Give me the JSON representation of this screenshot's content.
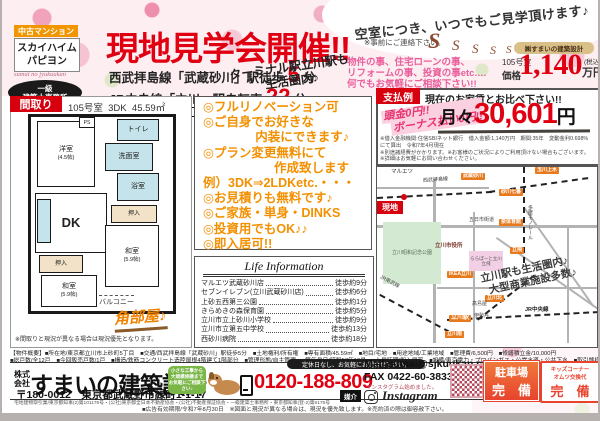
{
  "header": {
    "badge": "中古マンション",
    "building1": "スカイハイム",
    "building2": "パピヨン",
    "script": "sumai no jyukuukan",
    "license1": "一級",
    "license2": "建築士事務所",
    "title": "現地見学会開催!!",
    "access1_pre": "西武拝島線「武蔵砂川」駅徒歩",
    "access1_num": "5",
    "access1_unit": "分",
    "access2_pre": "JR中央線「立川」駅自転車",
    "access2_num": "22",
    "access2_unit": "分",
    "terminal1": "ターミナル駅立川駅も",
    "terminal2": "生活圏内♪",
    "vacancy": "空室につき、いつでもご見学頂けます♪",
    "contact": "※事前にご連絡下さい。",
    "mascot": "S",
    "company_pill": "㈱すまいの建築設計",
    "consult1": "物件の事、住宅ローンの事、",
    "consult2": "リフォームの事、投資の事etc.…",
    "consult3": "何でもお気軽にご相談下さい!!",
    "price_room": "105号室",
    "price_label": "価格",
    "price_value": "1,140",
    "price_tax": "(税込)",
    "price_unit": "万円"
  },
  "madori": {
    "label": "間取り",
    "room_no": "105号室",
    "layout": "3DK",
    "area": "45.59㎡",
    "rooms": {
      "western": "洋室",
      "western_size": "(4.5帖)",
      "ps": "PS",
      "toilet": "トイレ",
      "washroom": "洗面室",
      "bath": "浴室",
      "dk": "DK",
      "closet1": "押入",
      "closet2": "押入",
      "japanese1": "和室",
      "japanese1_size": "(5.9帖)",
      "japanese2": "和室",
      "japanese2_size": "(5.9帖)",
      "balcony": "バルコニー"
    },
    "corner": "角部屋♪",
    "note": "※間取りと現況が異なる場合は現況優先となります。"
  },
  "features": {
    "lines": [
      "◎フルリノベーション可",
      "◎ご自身でお好きな",
      "内装にできます♪",
      "◎プラン変更無料にて",
      "作成致します",
      "例）3DK⇒2LDKetc.・・・",
      "◎お見積りも無料です♪",
      "◎ご家族・単身・DINKS",
      "◎投資用でもOK♪♪",
      "◎即入居可!!"
    ]
  },
  "life": {
    "title": "Life Information",
    "items": [
      {
        "name": "マルエツ武蔵砂川店",
        "time": "徒歩約9分"
      },
      {
        "name": "セブンイレブン(立川武蔵砂川店)",
        "time": "徒歩約6分"
      },
      {
        "name": "上砂五西第三公園",
        "time": "徒歩約1分"
      },
      {
        "name": "きらめきの森保育園",
        "time": "徒歩約5分"
      },
      {
        "name": "立川市立上砂川小学校",
        "time": "徒歩約9分"
      },
      {
        "name": "立川市立第五中学校",
        "time": "徒歩約13分"
      },
      {
        "name": "西砂川病院",
        "time": "徒歩約18分"
      }
    ]
  },
  "payment": {
    "label": "支払例",
    "header": "現在のお家賃とお比べ下さい!!",
    "zero1": "頭金0円!!",
    "zero2": "ボーナス払い0円!!",
    "monthly_pre": "月々",
    "monthly_value": "30,601",
    "monthly_unit": "円",
    "note1": "※借入金融機関:住信SBIネット銀行　借入金額:1,140万円　期間:35年　変動金利0.698%にて算出　令和7年4月現在",
    "note2": "※別途諸経費がかかります。※お客様のご状況によりご利用頂けない場合もございます。",
    "note3": "※詳細はお気軽にお問い合わせください。"
  },
  "map": {
    "label": "MAP",
    "genchi": "現地",
    "maruetsu": "マルエツ",
    "seibu_line": "西武拝島線",
    "musashisunagawa": "武蔵砂川",
    "tamagawajosui": "玉川上水",
    "monorail": "多摩モノレール",
    "sunagawa7": "砂川七番",
    "izumi": "泉体育館",
    "tachihi": "立飛",
    "tachikawakita": "立川北",
    "tachikawa": "立川駅",
    "tachikawaminami": "立川南",
    "itsukaichi": "五日市街道",
    "cityhall": "立川市役所",
    "park": "立川昭和記念公園",
    "lalaport": "ららぽーと立川立飛",
    "ikea": "IKEA立川",
    "isetan": "伊勢丹",
    "takashimaya": "高島屋",
    "nambu": "JR南武線",
    "chuo": "JR中央線",
    "note1": "立川駅も生活圏内♪",
    "note2": "大型商業施設多数♪"
  },
  "overview": {
    "line1": "【物件概要】■所在地/東京都立川市上砂町5丁目　■交通/西武拝島線「武蔵砂川」駅徒歩5分　■土地権利/所有権　■専有面積/45.59㎡　■地目/宅地　■用途地域/工業地域　■管理費/6,500円　■修繕積立金/10,000円",
    "line2": "■総戸数/全12戸　■今回販売戸数/1戸　■構造/鉄筋コンクリート造陸屋根4階建て1階部分　■管理形態/自主管理　■築年月日/昭和57年10月　■入居時期/即入居可　■設備/東京電力・プロパンガス・公営水道・公共下水　■取引態様/媒介"
  },
  "footer": {
    "company_prefix1": "株式",
    "company_prefix2": "会社",
    "company_name": "すまいの建築設計",
    "address": "〒180-0012　東京都武蔵野市緑町1-1-17",
    "license": "宅地建物取引業/東京都知事(2)第101176号・(公社)東京都全日本不動産協会・(公社)不動産保証協会・一級建築士事務所・東京都知事(登-2)第6175号",
    "bubble1": "小さな工事から",
    "bubble2": "大規模修繕まで",
    "bubble3": "お気軽にご相談下さい♪",
    "hours": "定休日なし、お気軽にお問合せ下さい。",
    "phone": "0120-188-809",
    "mail": "Mail sumai@sjkuukan.com",
    "fax": "FAX 0422-60-3833",
    "insta_note": "インスタグラム始めました。",
    "insta": "Instagram",
    "baikai": "媒介",
    "parking1": "駐車場",
    "parking2": "完　備",
    "kids1": "キッズコーナー",
    "kids2": "オムツ交換代",
    "kids3": "完　備",
    "validity": "■広告有効期限/令和7年8月30日　※図面と現況が異なる場合は、現況を優先致します。※売約済の際は御容赦下さい。"
  }
}
